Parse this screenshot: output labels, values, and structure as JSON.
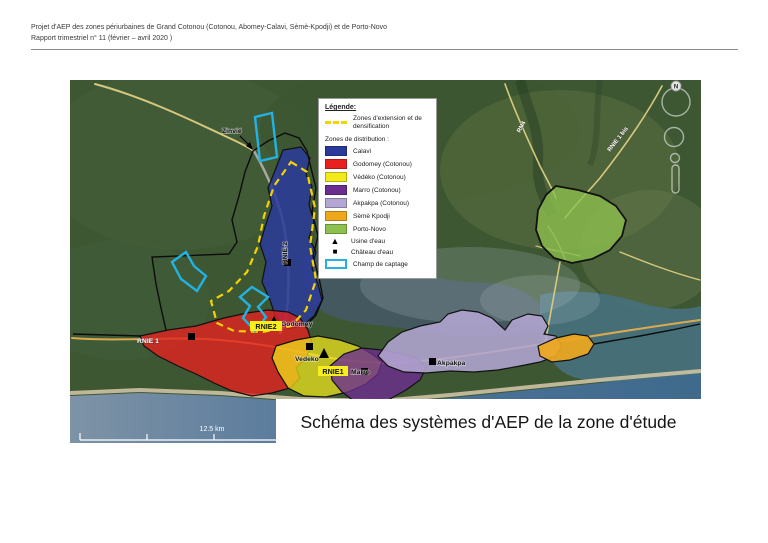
{
  "header": {
    "line1": "Projet d'AEP des zones périurbaines de Grand Cotonou (Cotonou, Abomey-Calavi, Sèmè-Kpodji) et de Porto-Novo",
    "line2": "Rapport trimestriel n° 11 (février – avril 2020 )"
  },
  "map": {
    "title": "Schéma des systèmes d'AEP de la zone d'étude",
    "scale_label": "12.5 km",
    "compass_label": "N",
    "labels": {
      "zinvie": "Zinvié",
      "rnie2_road": "RNIE-2",
      "rnie2_tag": "RNIE2",
      "rnie1_west": "RNIE 1",
      "rnie1_tag": "RNIE1",
      "godomey": "Godomey",
      "vedeko": "Vedeko",
      "marro": "Marro",
      "akpakpa": "Akpakpa",
      "rn4": "RN4",
      "rnie1bis": "RNIE 1 bis"
    }
  },
  "legend": {
    "title": "Légende:",
    "extension": {
      "label": "Zones d'extension et de densification",
      "color": "#f5d300"
    },
    "distribution_heading": "Zones de distribution :",
    "zones": [
      {
        "label": "Calavi",
        "color": "#2a3a9b"
      },
      {
        "label": "Godomey (Cotonou)",
        "color": "#e8201e"
      },
      {
        "label": "Védéko (Cotonou)",
        "color": "#f3e91c"
      },
      {
        "label": "Marro (Cotonou)",
        "color": "#6b2d90"
      },
      {
        "label": "Akpakpa (Cotonou)",
        "color": "#b3a6d3"
      },
      {
        "label": "Sèmè Kpodji",
        "color": "#efa71e"
      },
      {
        "label": "Porto-Novo",
        "color": "#8dc04e"
      }
    ],
    "symbols": [
      {
        "label": "Usine d'eau",
        "type": "triangle"
      },
      {
        "label": "Château d'eau",
        "type": "square"
      },
      {
        "label": "Champ de captage",
        "type": "cyan-rect",
        "color": "#23b2e2"
      }
    ]
  }
}
